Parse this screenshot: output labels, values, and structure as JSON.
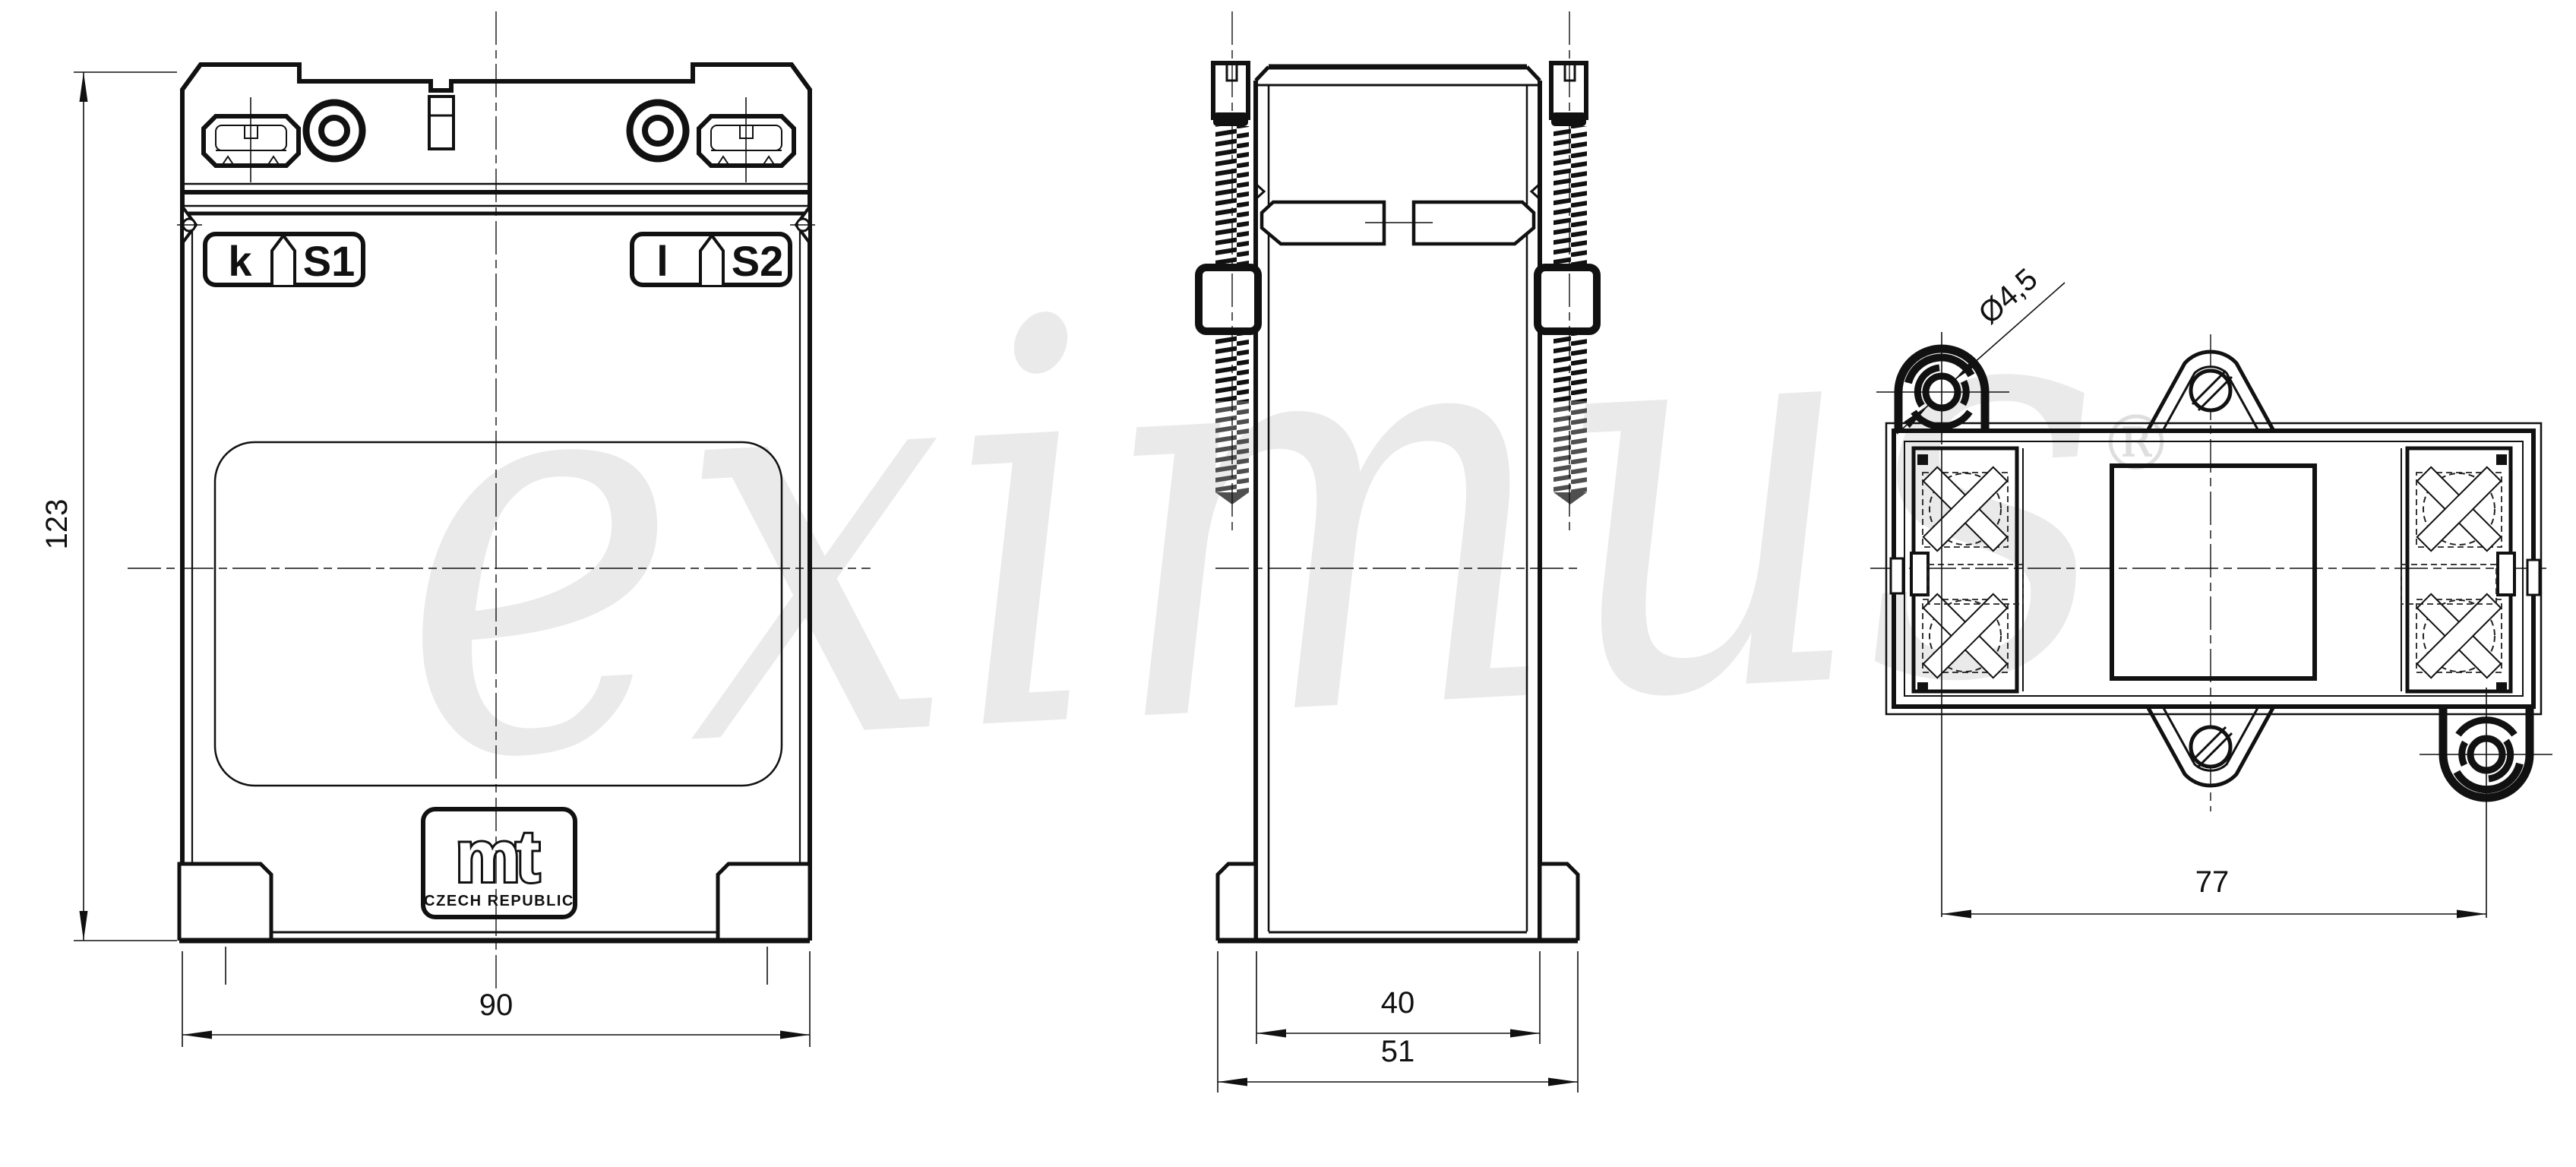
{
  "watermark": {
    "text": "eximus",
    "registered": "®"
  },
  "front_view": {
    "terminal_left": {
      "letter": "k",
      "name": "S1"
    },
    "terminal_right": {
      "letter": "l",
      "name": "S2"
    },
    "logo": {
      "brand": "mt",
      "country": "CZECH REPUBLIC"
    },
    "dims": {
      "height": "123",
      "width": "90"
    }
  },
  "side_view": {
    "dims": {
      "body_width": "40",
      "overall_width": "51"
    }
  },
  "top_view": {
    "dims": {
      "hole_diameter": "Ø4,5",
      "mounting_span": "77"
    }
  },
  "colors": {
    "line": "#111111",
    "phantom": "#4f4f4f",
    "watermark": "#eaeaea"
  }
}
